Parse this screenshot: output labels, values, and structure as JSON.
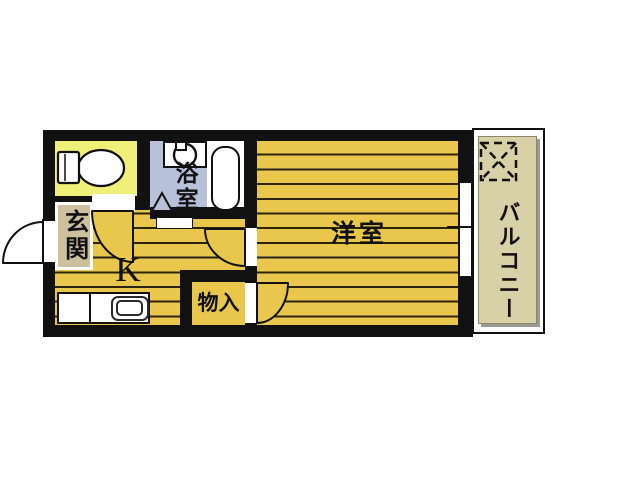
{
  "plan": {
    "type": "apartment-floor-plan",
    "rooms": {
      "entrance": {
        "label": "玄関"
      },
      "kitchen": {
        "label": "K"
      },
      "bathroom": {
        "label": "浴室"
      },
      "western_room": {
        "label": "洋室"
      },
      "storage": {
        "label": "物入"
      },
      "balcony": {
        "label": "バルコニー"
      }
    },
    "fixtures": {
      "toilet": "toilet-icon",
      "washing_machine": "washing-machine-icon",
      "bathtub": "bathtub-icon",
      "kitchen_sink": "kitchen-sink-icon",
      "outdoor_unit": "dashed-square-x-icon",
      "doors": "door-swing-arc-icon",
      "window": "window-opening"
    },
    "colors": {
      "wall": "#111111",
      "floor": "#e9c74d",
      "floor_line": "#2b2506",
      "toilet_room": "#eef078",
      "bathroom": "#b7c1da",
      "balcony": "#d8d0a6",
      "entrance_label_bg": "#cdc09e",
      "background": "#ffffff"
    }
  }
}
